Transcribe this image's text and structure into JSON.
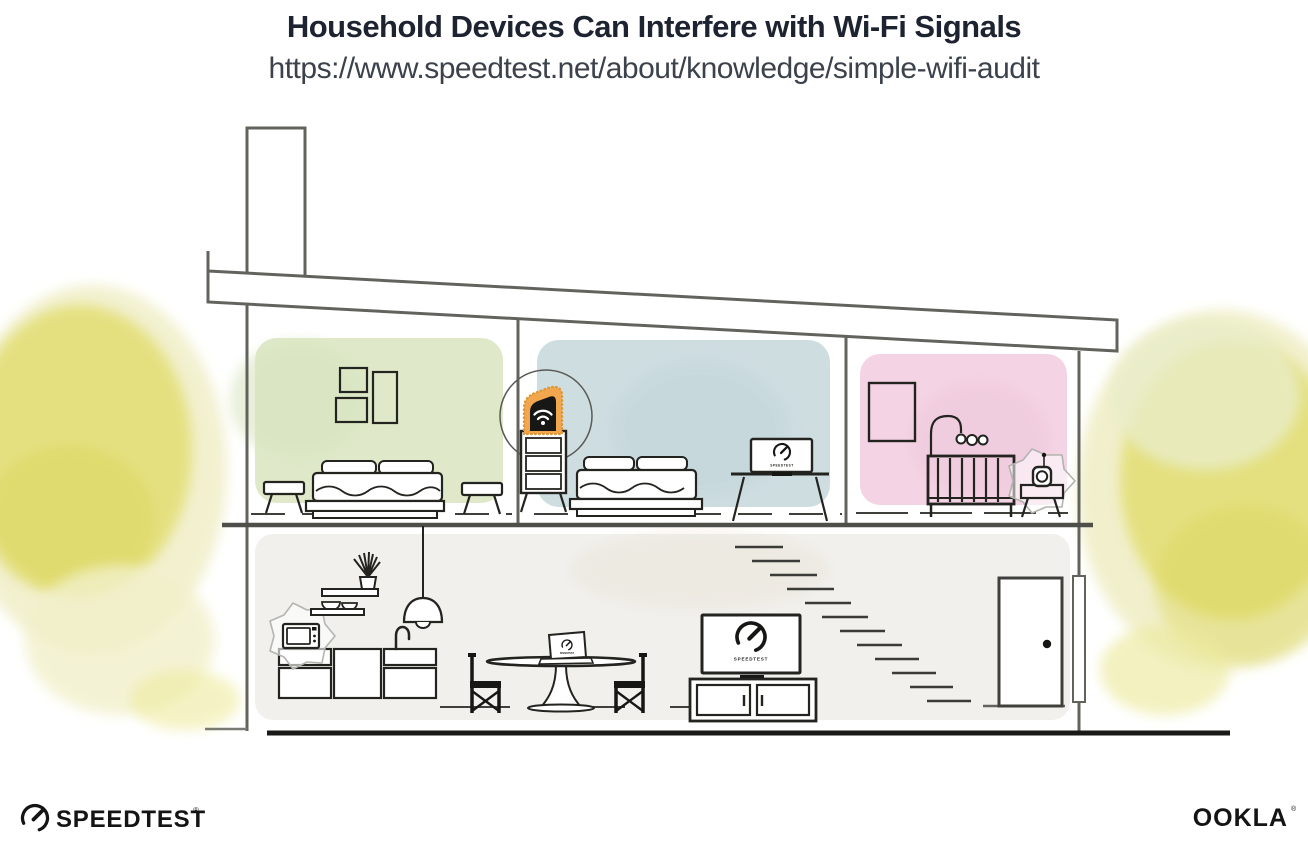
{
  "header": {
    "title": "Household Devices Can Interfere with Wi-Fi Signals",
    "url": "https://www.speedtest.net/about/knowledge/simple-wifi-audit"
  },
  "branding": {
    "speedtest": {
      "label": "SPEEDTEST",
      "trademark": "®",
      "icon": "speedtest-gauge-icon"
    },
    "ookla": {
      "label": "OOKLA",
      "trademark": "®"
    }
  },
  "illustration": {
    "screen_label": "SPEEDTEST",
    "highlighted_device": "wifi-router",
    "interference_sources": [
      "microwave",
      "baby-monitor"
    ],
    "devices": [
      "wifi-router",
      "desktop-monitor",
      "tv",
      "laptop",
      "microwave",
      "baby-monitor",
      "pendant-lamp"
    ],
    "rooms": [
      {
        "name": "bedroom-left",
        "wall_color": "#dfe9ca"
      },
      {
        "name": "bedroom-middle",
        "wall_color": "#cedde0"
      },
      {
        "name": "nursery",
        "wall_color": "#f4d4e4"
      },
      {
        "name": "living-area",
        "wall_color": "#f1f0ed"
      }
    ],
    "colors": {
      "title_text": "#1d2330",
      "url_text": "#3c424c",
      "router_highlight": "#f2a74e",
      "foliage": "#e3df78",
      "structure_line": "#63635e",
      "ink": "#161614"
    }
  }
}
